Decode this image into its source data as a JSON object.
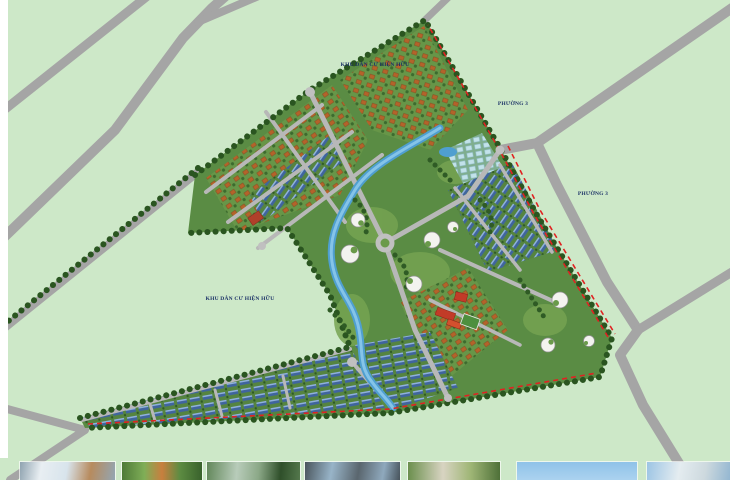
{
  "map": {
    "title": "Master plan of new urban residential area",
    "labels": {
      "existing_area_top": "KHU DÂN CƯ HIỆN HỮU",
      "existing_area_left": "KHU DÂN CƯ HIỆN HỮU",
      "ward_upper": "PHƯỜNG 3",
      "ward_lower": "PHƯỜNG 3"
    },
    "colors": {
      "background_green": "#cde8c8",
      "road_gray": "#a9a9a9",
      "site_green": "#5a8c44",
      "tree_dark_green": "#2a5520",
      "water_blue": "#4f9fd0",
      "villa_roof_orange": "#b4632a",
      "rowhouse_roof_blue": "#4a70ae",
      "boundary_dash_red": "#e02222",
      "label_navy": "#1a3066",
      "school_roof_red": "#c23b28"
    }
  },
  "gallery": {
    "count": 7,
    "items": [
      {
        "name": "perspective-photo-1"
      },
      {
        "name": "perspective-photo-2"
      },
      {
        "name": "perspective-photo-3"
      },
      {
        "name": "perspective-photo-4"
      },
      {
        "name": "perspective-photo-5"
      },
      {
        "name": "perspective-photo-6"
      },
      {
        "name": "perspective-photo-7"
      }
    ]
  }
}
